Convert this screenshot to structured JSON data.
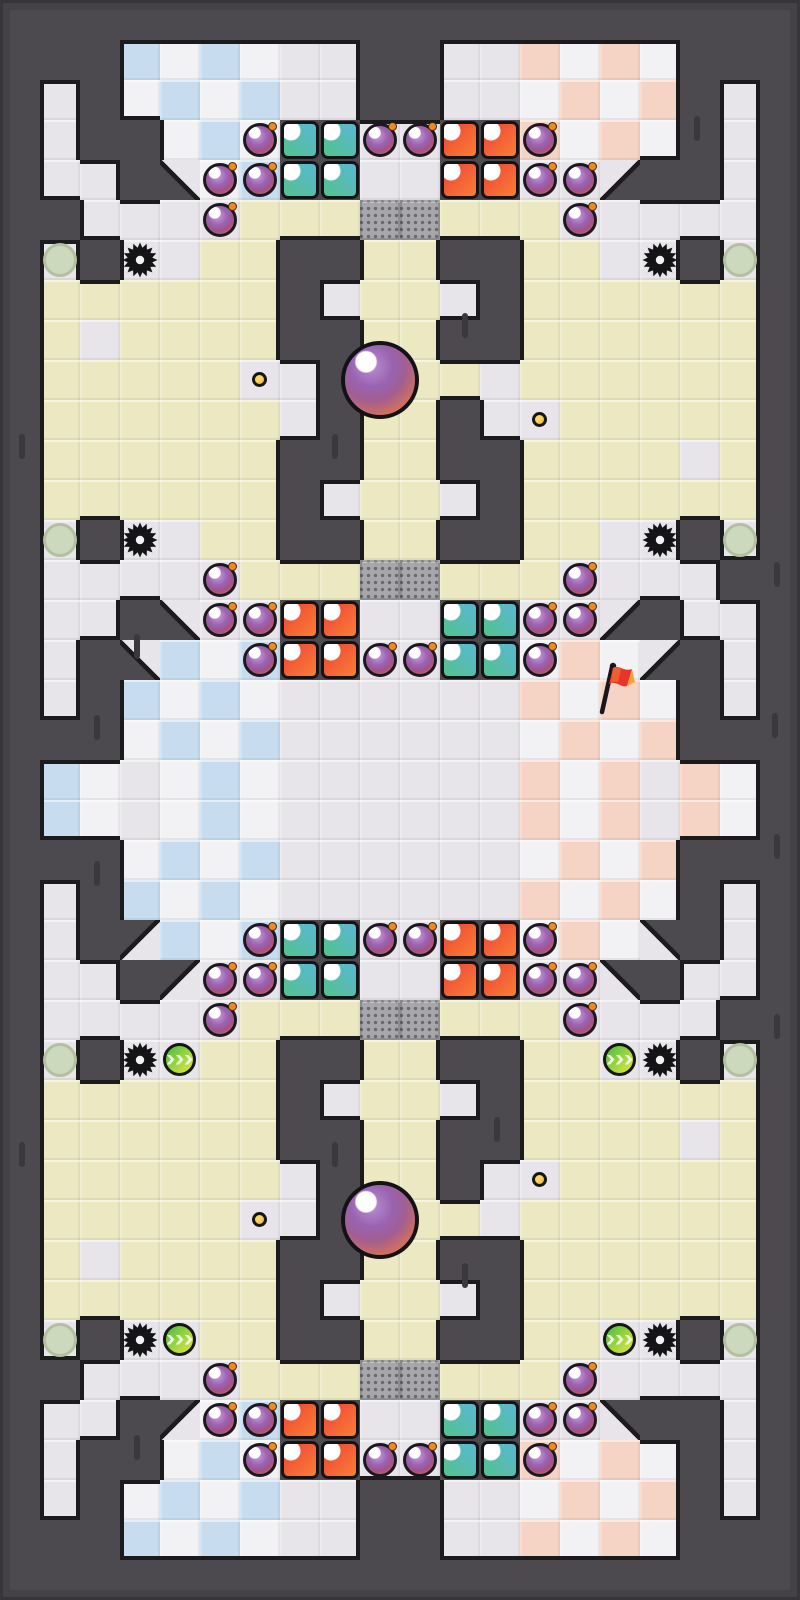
{
  "meta": {
    "app": "tile-arena-game-map",
    "view": "full-map-screenshot",
    "grid": {
      "cols": 20,
      "rows": 40,
      "tile_px": 40,
      "width_px": 800,
      "height_px": 1600
    }
  },
  "palette": {
    "wall": "#4c4a4e",
    "edge_shadow": "#1b1a1d",
    "floor_light": "#e7e5e9",
    "floor_yellow": "#ebe8c2",
    "checker_white": "#f2f1f4",
    "checker_blue": "#c7ddef",
    "checker_pink": "#f5d4c5",
    "crate": "#a7a6aa",
    "crate_dot": "#6b6a6f",
    "block_teal_a": "#5ab8d4",
    "block_teal_b": "#53c18c",
    "block_red_a": "#ef4133",
    "block_red_b": "#f97f38",
    "bomb_purple": "#9c64b4",
    "bomb_fuse_orange": "#f08a1f",
    "coin_gold": "#f0ad17",
    "orb_purple": "#9a63b1",
    "orb_orange": "#e8824d",
    "spawn_sage": "#cdd9bd",
    "boost_green": "#5fc143",
    "boost_yellow": "#e0e33e",
    "flag_red": "#e8352c",
    "flag_tip_orange": "#f5a23c",
    "gear_black": "#141316"
  },
  "board": {
    "legend": {
      "#": "wall",
      ".": "floor-light",
      "y": "floor-yellow",
      "k": "checker (blue left half / pink right half; colored cell if (col+row) even on top half, odd on bottom half)",
      "c": "crate-dotted",
      "T": "teal-block-cell",
      "R": "red-block-cell",
      "a": "diagonal wall SW-half",
      "b": "diagonal wall SE-half",
      "e": "diagonal wall NE-half",
      "f": "diagonal wall NW-half"
    },
    "rows": [
      "####################",
      "###kkkk..##..kkkk###",
      "#.#kkkk..##..kkkk#.#",
      "#.##kkkTT..RRkkkk#.#",
      "#..#akkTT..RR..b##.#",
      "##....yyyccyyy.....#",
      "#.#..yy##yy##yy..#.#",
      "#yyyyyy#.yy.#yyyyyy#",
      "#y.yyyy##yy##yyyyyy#",
      "#yyyyy..#yyy.yyyyyy#",
      "#yyyyyy.#yy#..yyyyy#",
      "#yyyyyy##yy##yyyy.y#",
      "#yyyyyy#.yy.#yyyyyy#",
      "#.#..yy##yy##yy..#.#",
      "#.....yyyccyyy....##",
      "#..#a..RR..TT..b#..#",
      "#.#akkkRR..TTkkkb#.#",
      "#.#kkkk......kkkk#.#",
      "###kkkk......kkkk###",
      "#kk.kkk......kkk.kk#",
      "#kk.kkk......kkk.kk#",
      "###kkkk......kkkk###",
      "#.#kkkk......kkkk#.#",
      "#.#fkkkTT..RRkkke#.#",
      "#..#f..TT..RR..e#..#",
      "#.....yyyccyyy....##",
      "#.#..yy##yy##yy..#.#",
      "#yyyyyy#.yy.#yyyyyy#",
      "#yyyyyy##yy##yyyy.y#",
      "#yyyyyy.#yy#..yyyyy#",
      "#yyyyy..#yyy.yyyyyy#",
      "#y.yyyy##yy##yyyyyy#",
      "#yyyyyy#.yy.#yyyyyy#",
      "#.#..yy##yy##yy..#.#",
      "##....yyyccyyy.....#",
      "#..#fkkRR..TT..e##.#",
      "#.##kkkRR..TTkkkk#.#",
      "#.#kkkk..##..kkkk#.#",
      "###kkkk..##..kkkk###",
      "####################"
    ]
  },
  "entities": {
    "bombs": [
      [
        6,
        3
      ],
      [
        9,
        3
      ],
      [
        10,
        3
      ],
      [
        13,
        3
      ],
      [
        5,
        4
      ],
      [
        6,
        4
      ],
      [
        13,
        4
      ],
      [
        14,
        4
      ],
      [
        5,
        5
      ],
      [
        14,
        5
      ],
      [
        5,
        14
      ],
      [
        14,
        14
      ],
      [
        5,
        15
      ],
      [
        6,
        15
      ],
      [
        13,
        15
      ],
      [
        14,
        15
      ],
      [
        6,
        16
      ],
      [
        9,
        16
      ],
      [
        10,
        16
      ],
      [
        13,
        16
      ],
      [
        6,
        23
      ],
      [
        9,
        23
      ],
      [
        10,
        23
      ],
      [
        13,
        23
      ],
      [
        5,
        24
      ],
      [
        6,
        24
      ],
      [
        13,
        24
      ],
      [
        14,
        24
      ],
      [
        5,
        25
      ],
      [
        14,
        25
      ],
      [
        5,
        34
      ],
      [
        14,
        34
      ],
      [
        5,
        35
      ],
      [
        6,
        35
      ],
      [
        13,
        35
      ],
      [
        14,
        35
      ],
      [
        6,
        36
      ],
      [
        9,
        36
      ],
      [
        10,
        36
      ],
      [
        13,
        36
      ]
    ],
    "coins": [
      [
        6,
        9
      ],
      [
        13,
        10
      ],
      [
        13,
        29
      ],
      [
        6,
        30
      ]
    ],
    "orbs_px": [
      [
        380,
        380
      ],
      [
        380,
        1220
      ]
    ],
    "gears": [
      [
        3,
        6
      ],
      [
        16,
        6
      ],
      [
        3,
        13
      ],
      [
        16,
        13
      ],
      [
        3,
        26
      ],
      [
        16,
        26
      ],
      [
        3,
        33
      ],
      [
        16,
        33
      ]
    ],
    "spawn_pads": [
      [
        1,
        6
      ],
      [
        18,
        6
      ],
      [
        1,
        13
      ],
      [
        18,
        13
      ],
      [
        1,
        26
      ],
      [
        18,
        26
      ],
      [
        1,
        33
      ],
      [
        18,
        33
      ]
    ],
    "boost_pads": [
      [
        4,
        26
      ],
      [
        15,
        26
      ],
      [
        4,
        33
      ],
      [
        15,
        33
      ]
    ],
    "flag": {
      "col": 15,
      "row": 17
    },
    "wall_dashes_px": [
      [
        697,
        128
      ],
      [
        777,
        574
      ],
      [
        775,
        725
      ],
      [
        335,
        446
      ],
      [
        465,
        325
      ],
      [
        137,
        646
      ],
      [
        97,
        727
      ],
      [
        22,
        446
      ],
      [
        497,
        1129
      ],
      [
        137,
        1447
      ],
      [
        335,
        1154
      ],
      [
        465,
        1275
      ],
      [
        97,
        873
      ],
      [
        777,
        846
      ],
      [
        777,
        1026
      ],
      [
        22,
        1154
      ]
    ]
  }
}
